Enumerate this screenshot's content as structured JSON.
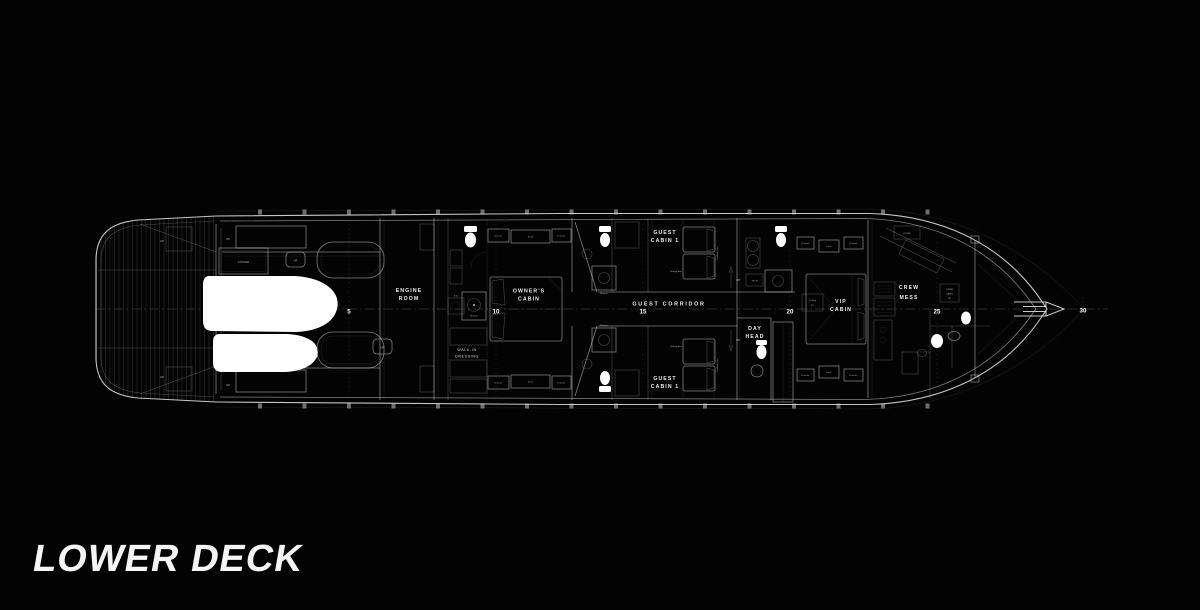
{
  "page": {
    "title": "LOWER DECK",
    "background": "#030303",
    "line_color": "#ffffff"
  },
  "frame_markers": [
    "5",
    "10",
    "15",
    "20",
    "25",
    "30"
  ],
  "rooms": {
    "locker": "LOCKER",
    "engine_room_1": "ENGINE",
    "engine_room_2": "ROOM",
    "walk_in_1": "WALK-IN",
    "walk_in_2": "DRESSING",
    "owners_1": "OWNER'S",
    "owners_2": "CABIN",
    "guest_corridor": "GUEST CORRIDOR",
    "guest_1": "GUEST",
    "guest_2": "CABIN 1",
    "day_head_1": "DAY",
    "day_head_2": "HEAD",
    "vip_1": "VIP",
    "vip_2": "CABIN",
    "crew_mess_1": "CREW",
    "crew_mess_2": "MESS",
    "store": "STORE",
    "crew_cabin_1": "CREW",
    "crew_cabin_2": "CABIN",
    "crew_cabin_3": "UP"
  },
  "fixtures": {
    "up": "UP",
    "shower": "Shower",
    "sink": "Sink",
    "dresser": "Dresser",
    "desk": "Desk",
    "sliding_bed": "Sliding bed",
    "pullman_bed": "Pullman bed",
    "tech": "TECH",
    "ceiling_tv_1": "Ceiling",
    "ceiling_tv_2": "TV"
  }
}
